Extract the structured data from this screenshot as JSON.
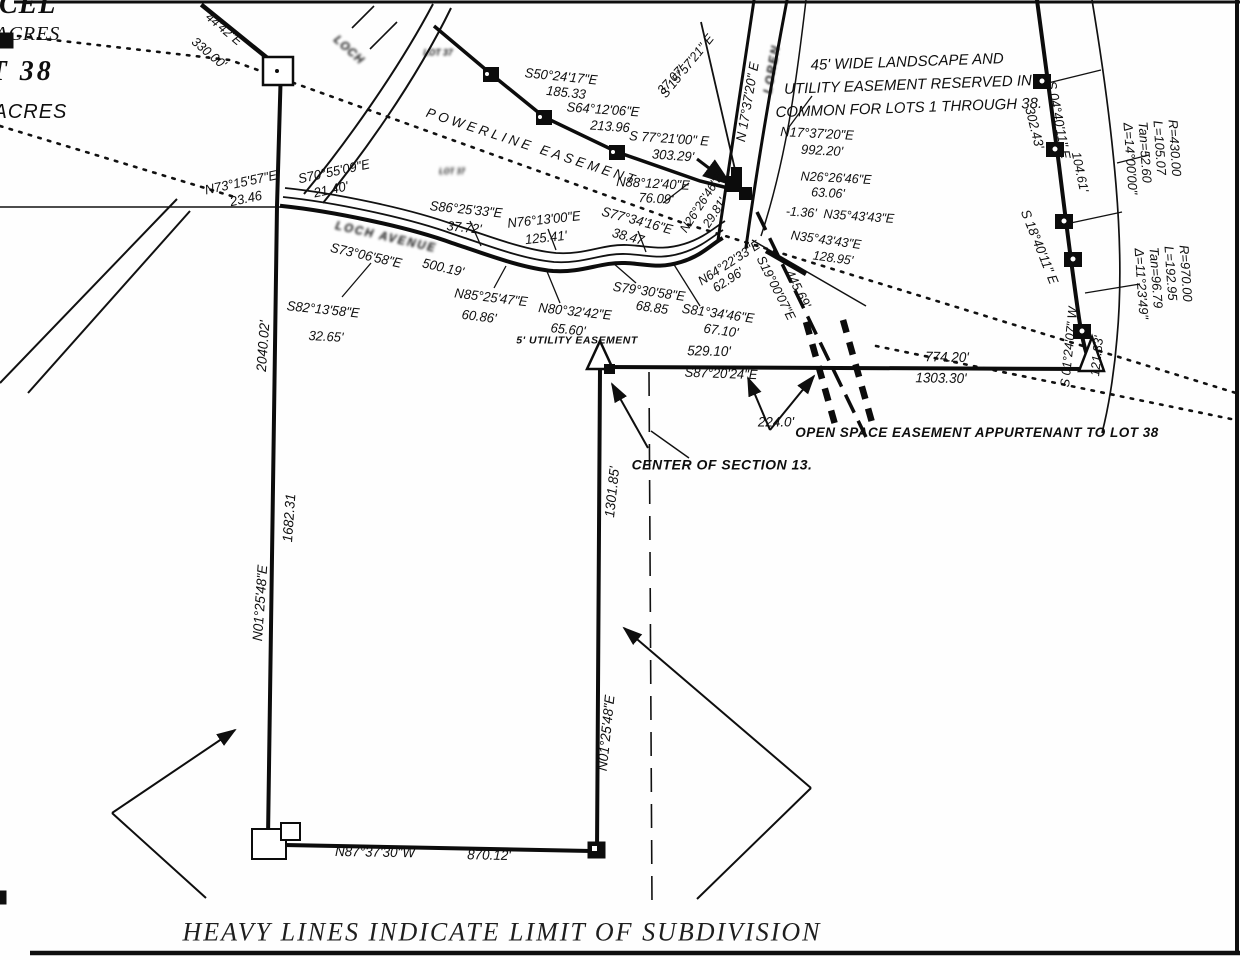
{
  "caption": {
    "text": "HEAVY LINES INDICATE LIMIT OF SUBDIVISION"
  },
  "parcels": {
    "lot38": {
      "name": "LOT 38",
      "area": "36.96 ACRES"
    },
    "remainder": {
      "line1": "REMAINDER",
      "line2": "PARCEL",
      "area": "20.00 ACRES"
    }
  },
  "notes": {
    "landscape_line1": "45' WIDE LANDSCAPE AND",
    "landscape_line2": "UTILITY EASEMENT RESERVED IN",
    "landscape_line3": "COMMON FOR LOTS 1 THROUGH 38.",
    "powerline": "POWERLINE EASEMENT",
    "utility5": "5' UTILITY EASEMENT",
    "open_space": "OPEN SPACE EASEMENT APPURTENANT TO LOT 38",
    "center_section": "CENTER OF SECTION 13."
  },
  "curves": [
    {
      "radius": "R=430.00",
      "arc": "L=105.07",
      "tangent": "Tan=52.60",
      "delta": "Δ=14°00'00\""
    },
    {
      "radius": "R=970.00",
      "arc": "L=192.95",
      "tangent": "Tan=96.79",
      "delta": "Δ=11°23'49\""
    }
  ],
  "labels": [
    {
      "n": "bearing-4442",
      "t": "44'42\"E",
      "x": 224,
      "y": 29,
      "r": 40,
      "s": 13
    },
    {
      "n": "dist-330",
      "t": "330.00'",
      "x": 209,
      "y": 53,
      "r": 40,
      "s": 13
    },
    {
      "n": "bearing-s502417",
      "t": "S50°24'17\"E",
      "x": 561,
      "y": 77,
      "r": 6,
      "s": 13.5
    },
    {
      "n": "dist-18533",
      "t": "185.33",
      "x": 566,
      "y": 93,
      "r": 6,
      "s": 13.5
    },
    {
      "n": "bearing-s641206",
      "t": "S64°12'06\"E",
      "x": 603,
      "y": 110,
      "r": 4,
      "s": 13.5
    },
    {
      "n": "dist-21396",
      "t": "213.96",
      "x": 610,
      "y": 127,
      "r": 4,
      "s": 13.5
    },
    {
      "n": "bearing-s772100",
      "t": "S 77°21'00\" E",
      "x": 669,
      "y": 139,
      "r": 4,
      "s": 13.5
    },
    {
      "n": "dist-30329",
      "t": "303.29'",
      "x": 673,
      "y": 156,
      "r": 4,
      "s": 13.5
    },
    {
      "n": "bearing-s155721",
      "t": "S 15°57'21\" E",
      "x": 687,
      "y": 66,
      "r": -51,
      "s": 13
    },
    {
      "n": "dist-3707",
      "t": "37.07'",
      "x": 671,
      "y": 80,
      "r": -48,
      "s": 13
    },
    {
      "n": "bearing-n173720-road",
      "t": "N 17°37'20\" E",
      "x": 748,
      "y": 102,
      "r": -80,
      "s": 13.5
    },
    {
      "n": "bearing-n173720",
      "t": "N17°37'20\"E",
      "x": 817,
      "y": 134,
      "r": 3,
      "s": 13.5
    },
    {
      "n": "dist-99220",
      "t": "992.20'",
      "x": 822,
      "y": 151,
      "r": 3,
      "s": 13.5
    },
    {
      "n": "bearing-n262646-east",
      "t": "N26°26'46\"E",
      "x": 836,
      "y": 178,
      "r": 3,
      "s": 13
    },
    {
      "n": "dist-6306",
      "t": "63.06'",
      "x": 828,
      "y": 193,
      "r": 3,
      "s": 13
    },
    {
      "n": "bearing-s044011",
      "t": "S 04°40'11\" E",
      "x": 1058,
      "y": 120,
      "r": 79,
      "s": 13.5
    },
    {
      "n": "dist-30243",
      "t": "302.43'",
      "x": 1034,
      "y": 128,
      "r": 76,
      "s": 13.5
    },
    {
      "n": "dist-10461",
      "t": "104.61'",
      "x": 1080,
      "y": 172,
      "r": 78,
      "s": 13
    },
    {
      "n": "bearing-s184011",
      "t": "S 18°40'11\" E",
      "x": 1039,
      "y": 247,
      "r": 68,
      "s": 13.5
    },
    {
      "n": "bearing-s012407",
      "t": "S 01°24'07\" W",
      "x": 1069,
      "y": 347,
      "r": -84,
      "s": 13
    },
    {
      "n": "dist-12183",
      "t": "121.83'",
      "x": 1097,
      "y": 356,
      "r": -84,
      "s": 13
    },
    {
      "n": "bearing-n731557",
      "t": "N73°15'57\"E",
      "x": 241,
      "y": 183,
      "r": -12,
      "s": 13.5
    },
    {
      "n": "dist-2346",
      "t": "23.46",
      "x": 246,
      "y": 199,
      "r": -12,
      "s": 13.5
    },
    {
      "n": "bearing-s705509",
      "t": "S70°55'09\"E",
      "x": 334,
      "y": 172,
      "r": -12,
      "s": 13.5
    },
    {
      "n": "dist-2140",
      "t": "21.40'",
      "x": 331,
      "y": 190,
      "r": -12,
      "s": 13.5
    },
    {
      "n": "bearing-s730658",
      "t": "S73°06'58\"E",
      "x": 366,
      "y": 256,
      "r": 13,
      "s": 13.5
    },
    {
      "n": "dist-50019",
      "t": "500.19'",
      "x": 443,
      "y": 268,
      "r": 13,
      "s": 13.5
    },
    {
      "n": "bearing-s821358",
      "t": "S82°13'58\"E",
      "x": 323,
      "y": 310,
      "r": 6,
      "s": 13.5
    },
    {
      "n": "dist-3265",
      "t": "32.65'",
      "x": 326,
      "y": 337,
      "r": 3,
      "s": 13.5
    },
    {
      "n": "bearing-s862533",
      "t": "S86°25'33\"E",
      "x": 466,
      "y": 210,
      "r": 6,
      "s": 13.5
    },
    {
      "n": "dist-3772",
      "t": "37.72'",
      "x": 464,
      "y": 228,
      "r": 6,
      "s": 13.5
    },
    {
      "n": "bearing-n761300",
      "t": "N76°13'00\"E",
      "x": 544,
      "y": 220,
      "r": -6,
      "s": 13.5
    },
    {
      "n": "dist-12541",
      "t": "125.41'",
      "x": 546,
      "y": 238,
      "r": -6,
      "s": 13.5
    },
    {
      "n": "bearing-s773416",
      "t": "S77°34'16\"E",
      "x": 637,
      "y": 221,
      "r": 15,
      "s": 13.5
    },
    {
      "n": "dist-3847",
      "t": "38.47",
      "x": 628,
      "y": 237,
      "r": 15,
      "s": 13.5
    },
    {
      "n": "bearing-n881240",
      "t": "N88°12'40\"E",
      "x": 653,
      "y": 184,
      "r": 3,
      "s": 13.5
    },
    {
      "n": "dist-7609",
      "t": "76.09'",
      "x": 656,
      "y": 199,
      "r": 3,
      "s": 13.5
    },
    {
      "n": "bearing-n262646-west",
      "t": "N26°26'46\"E",
      "x": 702,
      "y": 203,
      "r": -57,
      "s": 12.5
    },
    {
      "n": "dist-2981",
      "t": "29.81'",
      "x": 715,
      "y": 213,
      "r": -57,
      "s": 12.5
    },
    {
      "n": "dist-136-n354343",
      "t": "-1.36'  N35°43'43\"E",
      "x": 840,
      "y": 215,
      "r": 4,
      "s": 13
    },
    {
      "n": "bearing-n354343",
      "t": "N35°43'43\"E",
      "x": 826,
      "y": 240,
      "r": 8,
      "s": 13
    },
    {
      "n": "dist-12895",
      "t": "128.95'",
      "x": 833,
      "y": 258,
      "r": 8,
      "s": 13
    },
    {
      "n": "bearing-n642233",
      "t": "N64°22'33\"E",
      "x": 729,
      "y": 263,
      "r": -33,
      "s": 13
    },
    {
      "n": "dist-6296",
      "t": "62.96'",
      "x": 728,
      "y": 280,
      "r": -33,
      "s": 13
    },
    {
      "n": "bearing-s190007",
      "t": "S19°00'07\"E",
      "x": 776,
      "y": 288,
      "r": 63,
      "s": 13
    },
    {
      "n": "dist-44569",
      "t": "445.69'",
      "x": 798,
      "y": 289,
      "r": 63,
      "s": 13
    },
    {
      "n": "bearing-n852547",
      "t": "N85°25'47\"E",
      "x": 491,
      "y": 298,
      "r": 7,
      "s": 13.5
    },
    {
      "n": "dist-6086",
      "t": "60.86'",
      "x": 479,
      "y": 317,
      "r": 7,
      "s": 13.5
    },
    {
      "n": "bearing-n803242",
      "t": "N80°32'42\"E",
      "x": 575,
      "y": 312,
      "r": 6,
      "s": 13.5
    },
    {
      "n": "dist-6560",
      "t": "65.60'",
      "x": 568,
      "y": 330,
      "r": 6,
      "s": 13.5
    },
    {
      "n": "bearing-s793058",
      "t": "S79°30'58\"E",
      "x": 649,
      "y": 292,
      "r": 8,
      "s": 13.5
    },
    {
      "n": "dist-6885",
      "t": "68.85",
      "x": 652,
      "y": 308,
      "r": 8,
      "s": 13.5
    },
    {
      "n": "bearing-s813446",
      "t": "S81°34'46\"E",
      "x": 718,
      "y": 314,
      "r": 8,
      "s": 13.5
    },
    {
      "n": "dist-6710",
      "t": "67.10'",
      "x": 721,
      "y": 331,
      "r": 8,
      "s": 13.5
    },
    {
      "n": "dist-52910",
      "t": "529.10'",
      "x": 709,
      "y": 351,
      "r": 1,
      "s": 14
    },
    {
      "n": "bearing-s872024",
      "t": "S87°20'24\"E",
      "x": 721,
      "y": 374,
      "r": 2,
      "s": 13.5
    },
    {
      "n": "dist-77420",
      "t": "774.20'",
      "x": 947,
      "y": 357,
      "r": 1,
      "s": 14
    },
    {
      "n": "dist-130330",
      "t": "1303.30'",
      "x": 941,
      "y": 378,
      "r": 1,
      "s": 14
    },
    {
      "n": "dist-2240",
      "t": "224.0'",
      "x": 776,
      "y": 422,
      "r": 0,
      "s": 14
    },
    {
      "n": "dist-204002",
      "t": "2040.02'",
      "x": 263,
      "y": 346,
      "r": -86,
      "s": 14
    },
    {
      "n": "dist-168231",
      "t": "1682.31",
      "x": 289,
      "y": 518,
      "r": -86,
      "s": 14
    },
    {
      "n": "bearing-n012548-left",
      "t": "N01°25'48\"E",
      "x": 260,
      "y": 603,
      "r": -86,
      "s": 14
    },
    {
      "n": "dist-130185",
      "t": "1301.85'",
      "x": 612,
      "y": 492,
      "r": -84,
      "s": 14
    },
    {
      "n": "bearing-n012548-mid",
      "t": "N01°25'48\"E",
      "x": 606,
      "y": 733,
      "r": -84,
      "s": 14
    },
    {
      "n": "bearing-n873730",
      "t": "N87°37'30\"W",
      "x": 375,
      "y": 852,
      "r": 1,
      "s": 14
    },
    {
      "n": "dist-87012",
      "t": "870.12'",
      "x": 489,
      "y": 855,
      "r": 1,
      "s": 14
    },
    {
      "n": "road-name-loren",
      "t": "LOREN",
      "x": 772,
      "y": 69,
      "r": -80,
      "s": 12,
      "w": 700,
      "ls": 2,
      "bl": 1
    },
    {
      "n": "road-name-avenue",
      "t": "LOCH AVENUE",
      "x": 386,
      "y": 237,
      "r": 13,
      "s": 12,
      "w": 700,
      "ls": 2,
      "bl": 1.3
    },
    {
      "n": "road-name-upper",
      "t": "LOCH",
      "x": 349,
      "y": 50,
      "r": 42,
      "s": 12,
      "w": 700,
      "ls": 1,
      "bl": 1.4
    },
    {
      "n": "lot-marker-smudge-1",
      "t": "LOT 37",
      "x": 438,
      "y": 53,
      "r": 0,
      "s": 9,
      "w": 700,
      "bl": 1.4
    },
    {
      "n": "lot-marker-smudge-2",
      "t": "LOT 37",
      "x": 452,
      "y": 172,
      "r": 0,
      "s": 8,
      "w": 700,
      "bl": 1.5
    }
  ]
}
